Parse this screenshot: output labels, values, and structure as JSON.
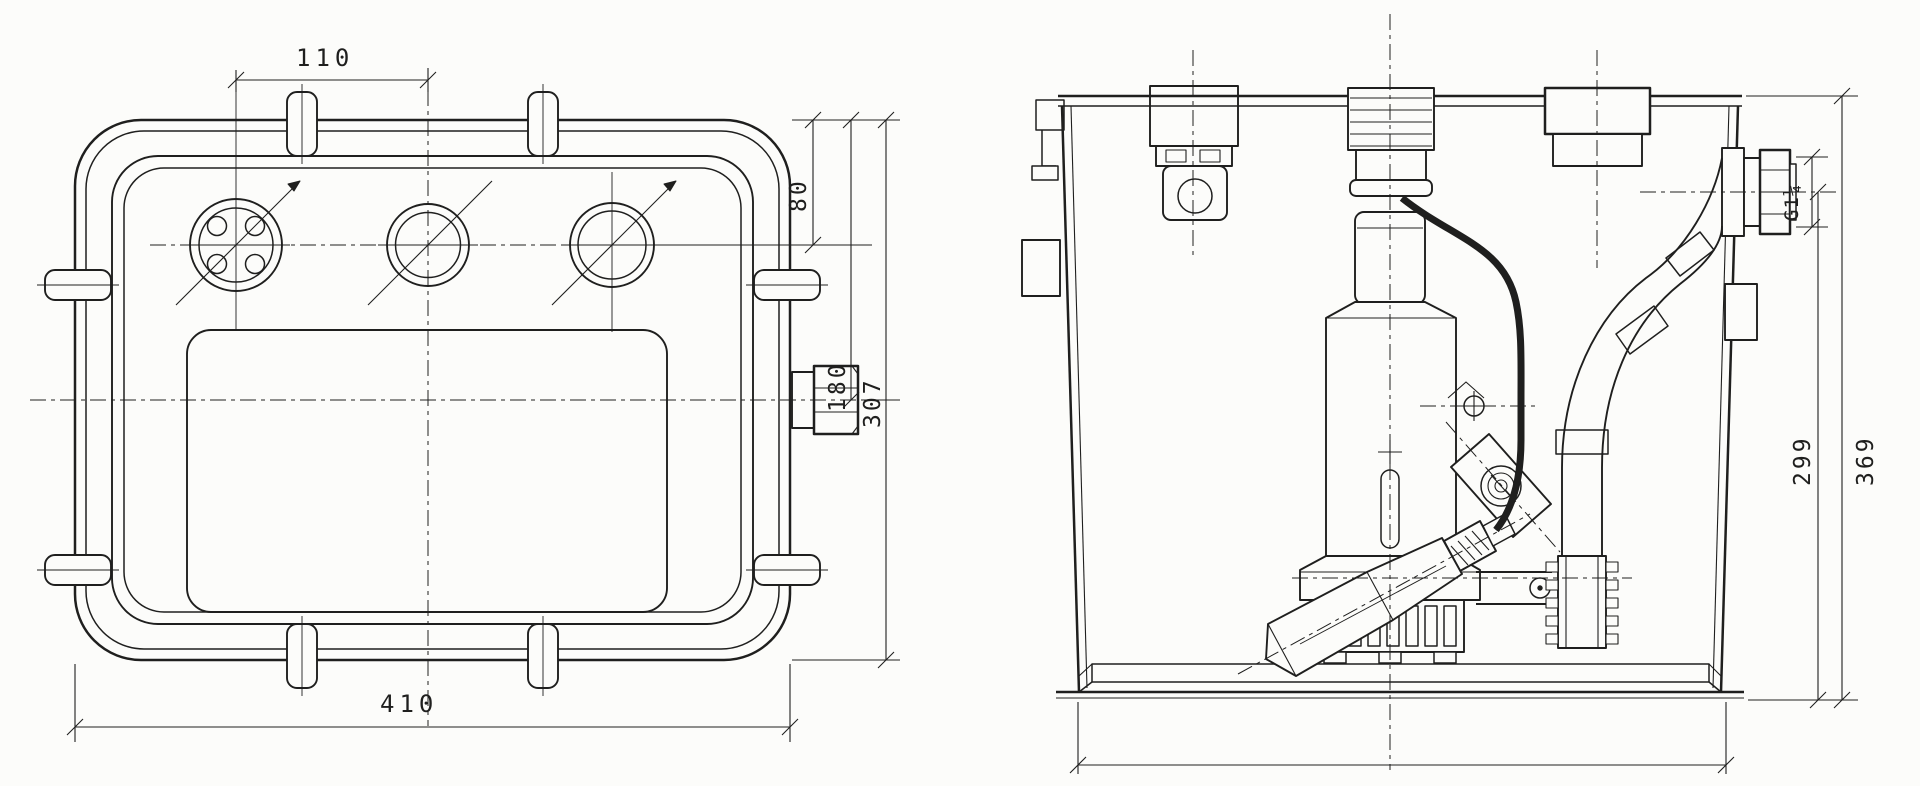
{
  "drawing": {
    "description": "Technical drawing of a lifting-station tank with submersible pump: plan view (left) and sectional side view (right)",
    "colors": {
      "ink": "#1f1f1e",
      "paper": "#fcfcfa"
    },
    "plan_view": {
      "dimensions": {
        "inlet_spacing": "110",
        "top_edge_to_inlet_centerline": "80",
        "top_edge_to_outlet_centerline": "180",
        "overall_depth": "307",
        "overall_width": "410"
      }
    },
    "section_view": {
      "dimensions": {
        "outlet_thread": "G1¼",
        "outlet_centerline_height": "299",
        "overall_height": "369"
      }
    }
  }
}
